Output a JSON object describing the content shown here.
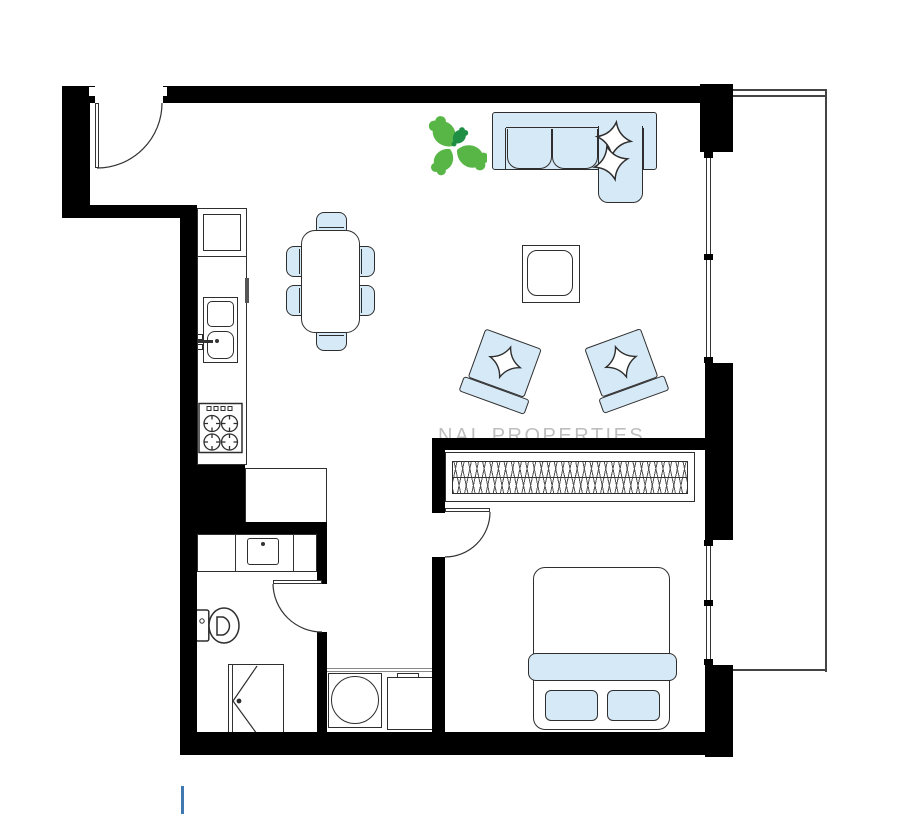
{
  "watermark": {
    "text": "NAL PROPERTIES"
  },
  "colors": {
    "wall": "#000000",
    "outline": "#2e2e2e",
    "furniture_fill": "#d6e9f6",
    "plant_light": "#58b647",
    "plant_dark": "#1e8f44",
    "watermark": "rgba(0,0,0,0.26)",
    "scale_mark": "#3f79b0",
    "thin_line": "#444444"
  },
  "floorplan": {
    "type": "apartment-floor-plan",
    "furniture": [
      "entrance-door",
      "corner-sofa",
      "throw-pillows",
      "plant",
      "coffee-table",
      "armchair-left",
      "armchair-right",
      "dining-table",
      "dining-chairs-x6",
      "tall-cabinet",
      "kitchen-counter",
      "kitchen-sink",
      "cooktop",
      "storage-unit",
      "bathroom-vanity",
      "toilet",
      "shower",
      "washing-machine",
      "laundry-cabinet",
      "wardrobe",
      "double-bed",
      "bed-pillows",
      "balcony",
      "windows"
    ]
  }
}
